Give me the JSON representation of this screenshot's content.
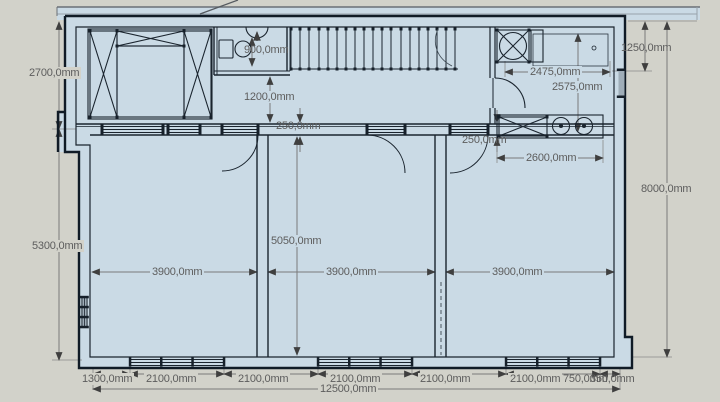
{
  "app": {
    "background_color": "#d2d2ca",
    "paper_color": "#cadae5",
    "wall_color": "#16202a",
    "dimension_line_color": "#7a7a7a",
    "dimension_text_color": "#5d5d5d",
    "unit": "mm"
  },
  "labels": {
    "d2700": "2700,0mm",
    "d5300": "5300,0mm",
    "d900": "900,0mm",
    "d1200": "1200,0mm",
    "d250_top": "250,0mm",
    "d250_right": "250,0mm",
    "d2475": "2475,0mm",
    "d2575": "2575,0mm",
    "d1250": "1250,0mm",
    "d8000": "8000,0mm",
    "d2600": "2600,0mm",
    "d5050": "5050,0mm",
    "d3900_a": "3900,0mm",
    "d3900_b": "3900,0mm",
    "d3900_c": "3900,0mm",
    "b1300": "1300,0mm",
    "b2100_1": "2100,0mm",
    "b2100_2": "2100,0mm",
    "b2100_3": "2100,0mm",
    "b2100_4": "2100,0mm",
    "b2100_5": "2100,0mm",
    "b750": "750,0mm",
    "b350": "350,0mm",
    "b12500": "12500,0mm"
  }
}
